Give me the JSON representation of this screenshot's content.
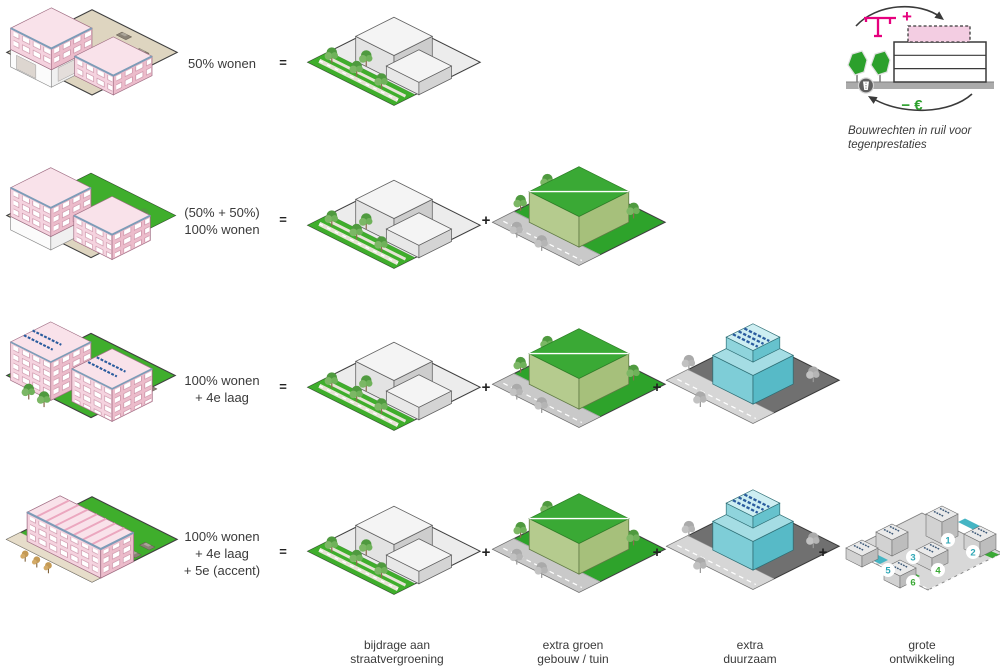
{
  "legend": {
    "caption": [
      "Bouwrechten in ruil voor",
      "tegenprestaties"
    ],
    "plus": "+",
    "minus_euro": "− €"
  },
  "operators": {
    "equals": "=",
    "plus": "+"
  },
  "rows": [
    {
      "label": [
        "50% wonen"
      ]
    },
    {
      "label": [
        "(50% + 50%)",
        "100% wonen"
      ]
    },
    {
      "label": [
        "100% wonen",
        "+ 4e laag"
      ]
    },
    {
      "label": [
        "100% wonen",
        "+ 4e laag",
        "+ 5e (accent)"
      ]
    }
  ],
  "footer": [
    [
      "bijdrage aan",
      "straatvergroening"
    ],
    [
      "extra groen",
      "gebouw / tuin"
    ],
    [
      "extra",
      "duurzaam"
    ],
    [
      "grote",
      "ontwikkeling"
    ]
  ],
  "development": {
    "markers": [
      {
        "n": "1",
        "color": "#2fa7b6"
      },
      {
        "n": "2",
        "color": "#2fa7b6"
      },
      {
        "n": "3",
        "color": "#2fa7b6"
      },
      {
        "n": "4",
        "color": "#3aa935"
      },
      {
        "n": "5",
        "color": "#2fa7b6"
      },
      {
        "n": "6",
        "color": "#3aa935"
      }
    ]
  },
  "colors": {
    "accent_pink": "#e6007e",
    "housing_pink": "#f5d3df",
    "green": "#3aa935",
    "sustainable_blue": "#7ecdd7",
    "marker_teal": "#2fa7b6"
  }
}
